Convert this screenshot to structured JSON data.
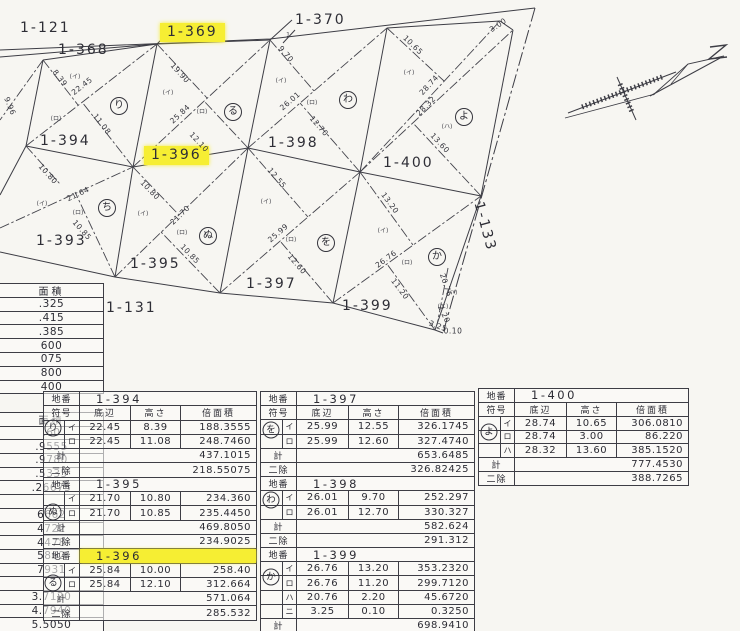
{
  "highlight_color": "#f6ee33",
  "ink_color": "#3d3d45",
  "map": {
    "labels": [
      {
        "t": "1-121",
        "x": 20,
        "y": 20
      },
      {
        "t": "1-368",
        "x": 58,
        "y": 42
      },
      {
        "t": "1-369",
        "x": 160,
        "y": 23,
        "hl": true
      },
      {
        "t": "1-370",
        "x": 295,
        "y": 12
      },
      {
        "t": "1-394",
        "x": 40,
        "y": 133
      },
      {
        "t": "1-396",
        "x": 144,
        "y": 146,
        "hl": true
      },
      {
        "t": "1-398",
        "x": 268,
        "y": 135
      },
      {
        "t": "1-400",
        "x": 383,
        "y": 155
      },
      {
        "t": "1-393",
        "x": 36,
        "y": 233
      },
      {
        "t": "1-395",
        "x": 130,
        "y": 256
      },
      {
        "t": "1-397",
        "x": 246,
        "y": 276
      },
      {
        "t": "1-399",
        "x": 342,
        "y": 298
      },
      {
        "t": "1-131",
        "x": 106,
        "y": 300
      },
      {
        "t": "1-133",
        "x": 486,
        "y": 200,
        "rot": 75
      }
    ],
    "measurements": [
      {
        "t": "8.39",
        "x": 60,
        "y": 78,
        "r": 52
      },
      {
        "t": "22.45",
        "x": 82,
        "y": 86,
        "r": -38
      },
      {
        "t": "11.08",
        "x": 102,
        "y": 124,
        "r": 52
      },
      {
        "t": "9.96",
        "x": 10,
        "y": 106,
        "r": 68
      },
      {
        "t": "19.90",
        "x": 180,
        "y": 73,
        "r": 48
      },
      {
        "t": "25.84",
        "x": 180,
        "y": 114,
        "r": -43
      },
      {
        "t": "12.10",
        "x": 199,
        "y": 142,
        "r": 47
      },
      {
        "t": "9.70",
        "x": 286,
        "y": 54,
        "r": 49
      },
      {
        "t": "26.01",
        "x": 290,
        "y": 101,
        "r": -41
      },
      {
        "t": "12.70",
        "x": 319,
        "y": 126,
        "r": 49
      },
      {
        "t": "10.65",
        "x": 413,
        "y": 45,
        "r": 44
      },
      {
        "t": "28.74",
        "x": 429,
        "y": 85,
        "r": -47
      },
      {
        "t": "28.32",
        "x": 426,
        "y": 106,
        "r": -45
      },
      {
        "t": "13.60",
        "x": 440,
        "y": 143,
        "r": 47
      },
      {
        "t": "3.00",
        "x": 498,
        "y": 25,
        "r": -35
      },
      {
        "t": "10.80",
        "x": 48,
        "y": 174,
        "r": 48
      },
      {
        "t": "21.64",
        "x": 78,
        "y": 194,
        "r": -25
      },
      {
        "t": "10.85",
        "x": 82,
        "y": 230,
        "r": 48
      },
      {
        "t": "10.80",
        "x": 150,
        "y": 190,
        "r": 46
      },
      {
        "t": "21.70",
        "x": 180,
        "y": 215,
        "r": -44
      },
      {
        "t": "10.85",
        "x": 190,
        "y": 254,
        "r": 46
      },
      {
        "t": "12.55",
        "x": 277,
        "y": 178,
        "r": 50
      },
      {
        "t": "25.99",
        "x": 278,
        "y": 233,
        "r": -41
      },
      {
        "t": "12.60",
        "x": 297,
        "y": 264,
        "r": 49
      },
      {
        "t": "13.20",
        "x": 390,
        "y": 203,
        "r": 54
      },
      {
        "t": "26.76",
        "x": 386,
        "y": 259,
        "r": -36
      },
      {
        "t": "11.20",
        "x": 400,
        "y": 289,
        "r": 53
      },
      {
        "t": "20.76",
        "x": 446,
        "y": 285,
        "r": 72
      },
      {
        "t": "2.20",
        "x": 444,
        "y": 314,
        "r": 65
      },
      {
        "t": "3.25",
        "x": 438,
        "y": 326,
        "r": 20
      },
      {
        "t": "0.10",
        "x": 453,
        "y": 331,
        "r": 0
      }
    ],
    "symbols": [
      {
        "t": "り",
        "x": 119,
        "y": 106
      },
      {
        "t": "る",
        "x": 233,
        "y": 112
      },
      {
        "t": "わ",
        "x": 348,
        "y": 100
      },
      {
        "t": "よ",
        "x": 464,
        "y": 117
      },
      {
        "t": "ち",
        "x": 107,
        "y": 208
      },
      {
        "t": "ぬ",
        "x": 208,
        "y": 236
      },
      {
        "t": "を",
        "x": 326,
        "y": 243
      },
      {
        "t": "か",
        "x": 437,
        "y": 257
      }
    ],
    "marks": [
      {
        "t": "(イ)",
        "x": 75,
        "y": 76
      },
      {
        "t": "(ロ)",
        "x": 56,
        "y": 118
      },
      {
        "t": "(イ)",
        "x": 168,
        "y": 92
      },
      {
        "t": "(ロ)",
        "x": 202,
        "y": 111
      },
      {
        "t": "(イ)",
        "x": 281,
        "y": 80
      },
      {
        "t": "(ロ)",
        "x": 312,
        "y": 102
      },
      {
        "t": "(イ)",
        "x": 409,
        "y": 72
      },
      {
        "t": "(ハ)",
        "x": 447,
        "y": 126
      },
      {
        "t": "(イ)",
        "x": 42,
        "y": 203
      },
      {
        "t": "(ロ)",
        "x": 78,
        "y": 212
      },
      {
        "t": "(イ)",
        "x": 143,
        "y": 213
      },
      {
        "t": "(ロ)",
        "x": 182,
        "y": 232
      },
      {
        "t": "(イ)",
        "x": 266,
        "y": 201
      },
      {
        "t": "(ロ)",
        "x": 291,
        "y": 239
      },
      {
        "t": "(イ)",
        "x": 383,
        "y": 230
      },
      {
        "t": "(ロ)",
        "x": 407,
        "y": 262
      },
      {
        "t": "(ハ)",
        "x": 452,
        "y": 292
      },
      {
        "t": "(ニ)",
        "x": 443,
        "y": 306
      },
      {
        "t": "1",
        "x": 288,
        "y": 35
      }
    ]
  },
  "table_labels": {
    "ban": "地番",
    "sym": "符号",
    "base": "底辺",
    "height": "高さ",
    "area": "倍面積",
    "sum": "計",
    "half": "二除"
  },
  "tables": {
    "t1": {
      "x": 43,
      "y": 391,
      "rh": 14.3,
      "cols": [
        21,
        15,
        51,
        50,
        75
      ],
      "rows": [
        {
          "t": "ban",
          "v": "1-394"
        },
        {
          "t": "hdr"
        },
        {
          "t": "d",
          "s": "イ",
          "b": "22.45",
          "h": "8.39",
          "a": "188.3555"
        },
        {
          "t": "d",
          "s": "ロ",
          "b": "22.45",
          "h": "11.08",
          "a": "248.7460"
        },
        {
          "t": "sum",
          "v": "437.1015"
        },
        {
          "t": "niv",
          "v": "218.55075"
        },
        {
          "t": "ban",
          "v": "1-395"
        },
        {
          "t": "d",
          "s": "イ",
          "b": "21.70",
          "h": "10.80",
          "a": "234.360"
        },
        {
          "t": "d",
          "s": "ロ",
          "b": "21.70",
          "h": "10.85",
          "a": "235.4450"
        },
        {
          "t": "sum",
          "v": "469.8050"
        },
        {
          "t": "niv",
          "v": "234.9025"
        },
        {
          "t": "ban",
          "v": "1-396",
          "hl": true
        },
        {
          "t": "d",
          "s": "イ",
          "b": "25.84",
          "h": "10.00",
          "a": "258.40"
        },
        {
          "t": "d",
          "s": "ロ",
          "b": "25.84",
          "h": "12.10",
          "a": "312.664"
        },
        {
          "t": "sum",
          "v": "571.064"
        },
        {
          "t": "niv",
          "v": "285.532"
        }
      ]
    },
    "t2": {
      "x": 260,
      "y": 391,
      "rh": 14.2,
      "cols": [
        22,
        14,
        52,
        50,
        75
      ],
      "rows": [
        {
          "t": "ban",
          "v": "1-397"
        },
        {
          "t": "hdr"
        },
        {
          "t": "d",
          "s": "イ",
          "b": "25.99",
          "h": "12.55",
          "a": "326.1745"
        },
        {
          "t": "d",
          "s": "ロ",
          "b": "25.99",
          "h": "12.60",
          "a": "327.4740"
        },
        {
          "t": "sum",
          "v": "653.6485"
        },
        {
          "t": "niv",
          "v": "326.82425"
        },
        {
          "t": "ban",
          "v": "1-398"
        },
        {
          "t": "d",
          "s": "イ",
          "b": "26.01",
          "h": "9.70",
          "a": "252.297"
        },
        {
          "t": "d",
          "s": "ロ",
          "b": "26.01",
          "h": "12.70",
          "a": "330.327"
        },
        {
          "t": "sum",
          "v": "582.624"
        },
        {
          "t": "niv",
          "v": "291.312"
        },
        {
          "t": "ban",
          "v": "1-399"
        },
        {
          "t": "d",
          "s": "イ",
          "b": "26.76",
          "h": "13.20",
          "a": "353.2320"
        },
        {
          "t": "d",
          "s": "ロ",
          "b": "26.76",
          "h": "11.20",
          "a": "299.7120"
        },
        {
          "t": "d",
          "s": "ハ",
          "b": "20.76",
          "h": "2.20",
          "a": "45.6720"
        },
        {
          "t": "d",
          "s": "ニ",
          "b": "3.25",
          "h": "0.10",
          "a": "0.3250"
        },
        {
          "t": "sum",
          "v": "698.9410"
        }
      ]
    },
    "t3": {
      "x": 478,
      "y": 388,
      "rh": 13.85,
      "cols": [
        22,
        14,
        52,
        50,
        71
      ],
      "rows": [
        {
          "t": "ban",
          "v": "1-400"
        },
        {
          "t": "hdr"
        },
        {
          "t": "d",
          "s": "イ",
          "b": "28.74",
          "h": "10.65",
          "a": "306.0810"
        },
        {
          "t": "d",
          "s": "ロ",
          "b": "28.74",
          "h": "3.00",
          "a": "86.220"
        },
        {
          "t": "d",
          "s": "ハ",
          "b": "28.32",
          "h": "13.60",
          "a": "385.1520"
        },
        {
          "t": "sum",
          "v": "777.4530"
        },
        {
          "t": "niv",
          "v": "388.7265"
        }
      ]
    }
  },
  "table_symbols": [
    {
      "t": "り",
      "x": 53,
      "y": 428
    },
    {
      "t": "ぬ",
      "x": 53,
      "y": 512
    },
    {
      "t": "る",
      "x": 53,
      "y": 583
    },
    {
      "t": "を",
      "x": 271,
      "y": 430
    },
    {
      "t": "わ",
      "x": 271,
      "y": 500
    },
    {
      "t": "か",
      "x": 271,
      "y": 577
    },
    {
      "t": "よ",
      "x": 489,
      "y": 432
    }
  ],
  "fragments": {
    "f1": {
      "x": 0,
      "y": 283,
      "w": 103,
      "rh": 13.8,
      "rows": [
        "面積",
        ".325",
        ".415",
        ".385",
        "600",
        "075",
        "800",
        "400"
      ]
    },
    "f2": {
      "x": 0,
      "y": 412,
      "w": 103,
      "rh": 13.7,
      "rows": [
        "面積",
        ".60",
        ".9555",
        ".9780",
        ".5335",
        ".26675",
        "",
        "6662",
        "4722",
        "4478",
        "5862",
        "7931",
        "",
        "3.7120",
        "4.7940",
        "5.5050"
      ]
    }
  }
}
